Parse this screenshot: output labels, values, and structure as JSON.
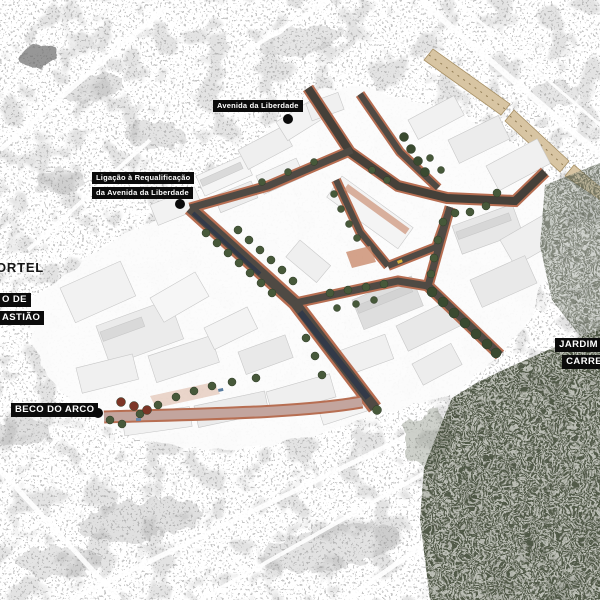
{
  "map": {
    "kind": "urban-requalification-masterplan-axonometric",
    "labels": {
      "avenida": {
        "text": "Avenida da Liberdade"
      },
      "ligacao": {
        "line1": "Ligação à Requalificação",
        "line2": "da Avenida da Liberdade"
      },
      "cortel": {
        "text": "ORTEL"
      },
      "sebastiao": {
        "line1": "O DE",
        "line2": "ASTIÃO"
      },
      "beco": {
        "text": "BECO DO ARCO"
      },
      "jardim": {
        "line1": "JARDIM",
        "line2": "CARREI"
      }
    },
    "colors": {
      "background": "#fafafa",
      "label_bg": "#0b0b0b",
      "label_text": "#ffffff",
      "sidewalk_terracotta": "#b76e52",
      "asphalt": "#4f4a44",
      "avenue_asphalt": "#454039",
      "pedestrian_pink": "#c3a59e",
      "tree_green": "#47593a",
      "tree_dark": "#3a4a30",
      "tree_red": "#7c3526",
      "roof_tan": "#d8c5a3",
      "water_navy": "#333a48",
      "vegetation_dark": "#6d7467",
      "plaza_salmon": "#c98b6d"
    }
  }
}
